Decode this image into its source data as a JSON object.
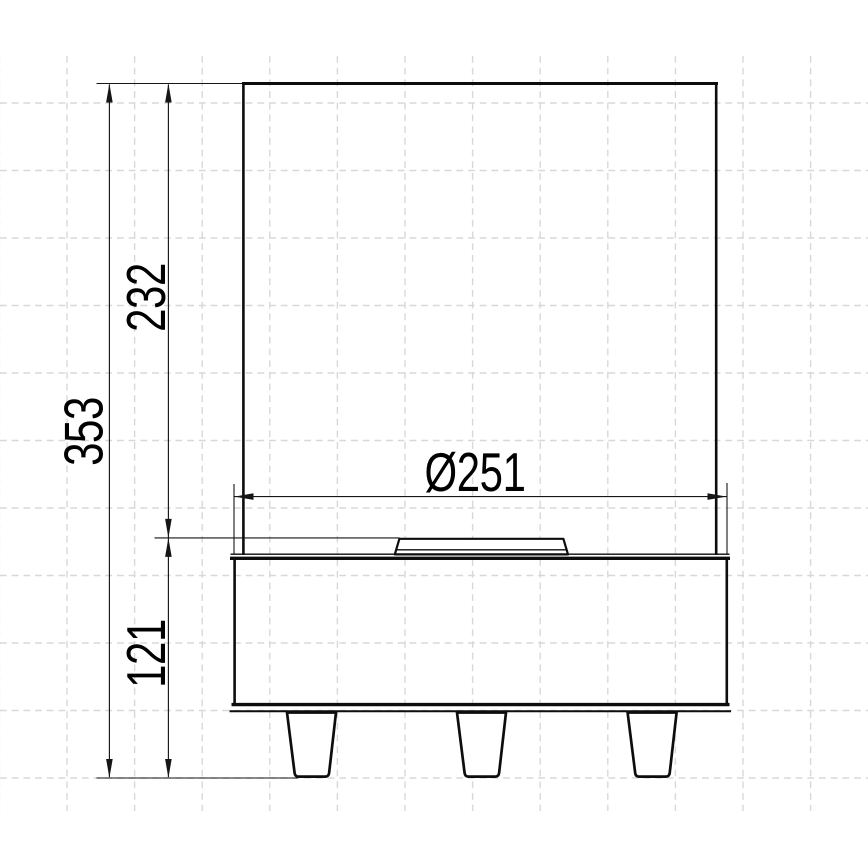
{
  "drawing": {
    "labels": {
      "total_height": "353",
      "glass_height": "232",
      "base_height": "121",
      "base_diameter": "Ø251"
    }
  },
  "colors": {
    "object_line": "#0d0d0d",
    "dimension_line": "#161616",
    "grid_line": "#d8d8d8",
    "background": "#ffffff",
    "text": "#000000"
  }
}
